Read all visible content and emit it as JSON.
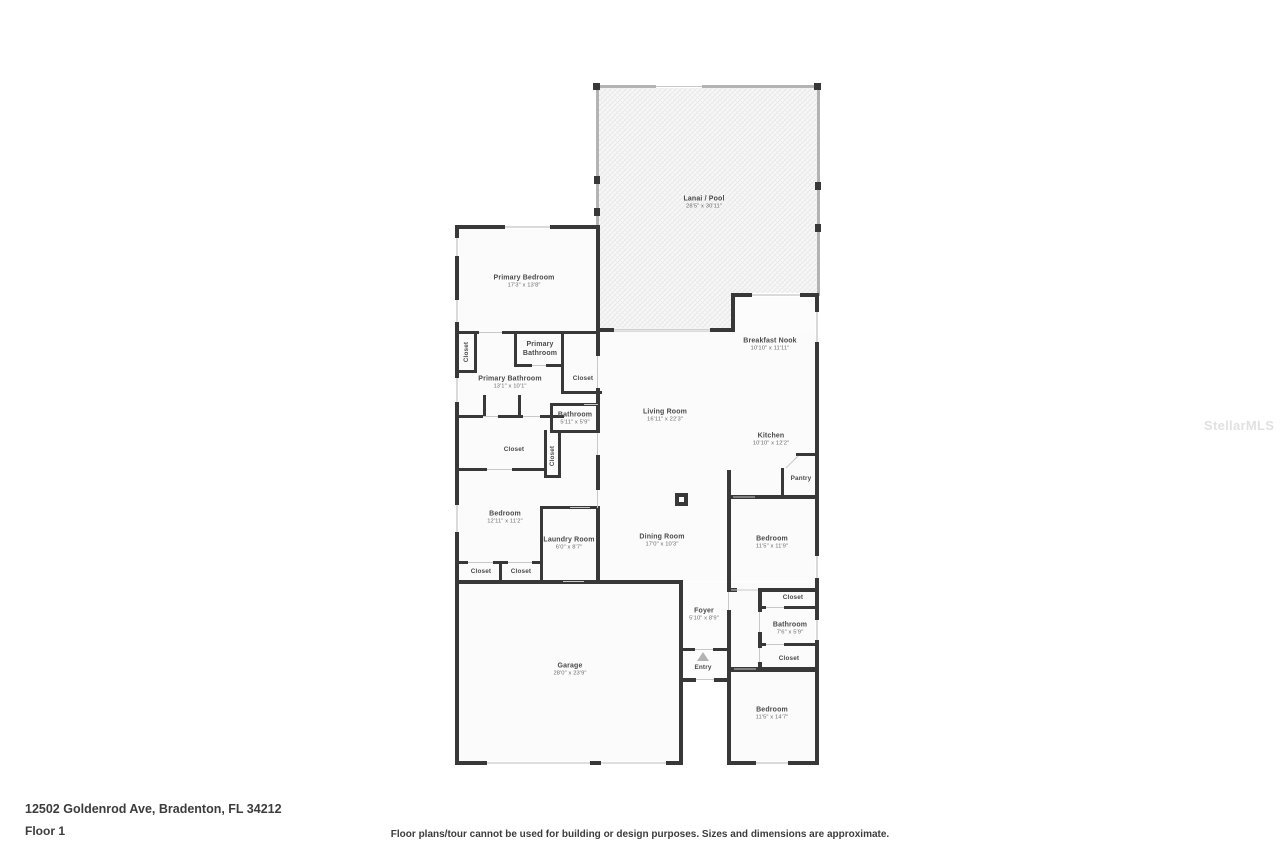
{
  "watermark": "StellarMLS",
  "footer": {
    "address": "12502 Goldenrod Ave, Bradenton, FL 34212",
    "floor_label": "Floor 1",
    "disclaimer": "Floor plans/tour cannot be used for building or design purposes. Sizes and dimensions are approximate."
  },
  "colors": {
    "wall": "#383838",
    "screen_wall": "#b3b3b3",
    "floor": "#fbfbfb",
    "label": "#4a4a4a"
  },
  "rooms": {
    "lanai_pool": {
      "name": "Lanai / Pool",
      "dims": "28'5\" x 30'11\""
    },
    "primary_bedroom": {
      "name": "Primary Bedroom",
      "dims": "17'3\" x 13'8\""
    },
    "primary_bathroom_upper": {
      "name": "Primary Bathroom",
      "dims": ""
    },
    "closet_primary_left": {
      "name": "Closet",
      "dims": ""
    },
    "primary_bathroom": {
      "name": "Primary Bathroom",
      "dims": "13'1\" x 10'1\""
    },
    "closet_hall_upper": {
      "name": "Closet",
      "dims": ""
    },
    "bathroom_hall": {
      "name": "Bathroom",
      "dims": "5'11\" x 5'9\""
    },
    "closet_hall_large": {
      "name": "Closet",
      "dims": ""
    },
    "closet_hall_vertical": {
      "name": "Closet",
      "dims": ""
    },
    "bedroom_left": {
      "name": "Bedroom",
      "dims": "12'11\" x 11'2\""
    },
    "laundry_room": {
      "name": "Laundry Room",
      "dims": "6'0\" x 8'7\""
    },
    "closet_bedroom_left_a": {
      "name": "Closet",
      "dims": ""
    },
    "closet_bedroom_left_b": {
      "name": "Closet",
      "dims": ""
    },
    "living_room": {
      "name": "Living Room",
      "dims": "16'11\" x 22'3\""
    },
    "breakfast_nook": {
      "name": "Breakfast Nook",
      "dims": "10'10\" x 11'11\""
    },
    "kitchen": {
      "name": "Kitchen",
      "dims": "10'10\" x 12'2\""
    },
    "pantry": {
      "name": "Pantry",
      "dims": ""
    },
    "dining_room": {
      "name": "Dining Room",
      "dims": "17'0\" x 10'3\""
    },
    "bedroom_right_mid": {
      "name": "Bedroom",
      "dims": "11'5\" x 11'9\""
    },
    "closet_right_upper": {
      "name": "Closet",
      "dims": ""
    },
    "bathroom_right": {
      "name": "Bathroom",
      "dims": "7'6\" x 5'9\""
    },
    "closet_right_lower": {
      "name": "Closet",
      "dims": ""
    },
    "foyer": {
      "name": "Foyer",
      "dims": "5'10\" x 8'9\""
    },
    "entry": {
      "name": "Entry",
      "dims": ""
    },
    "bedroom_right_bottom": {
      "name": "Bedroom",
      "dims": "11'5\" x 14'7\""
    },
    "garage": {
      "name": "Garage",
      "dims": "28'0\" x 23'9\""
    }
  }
}
